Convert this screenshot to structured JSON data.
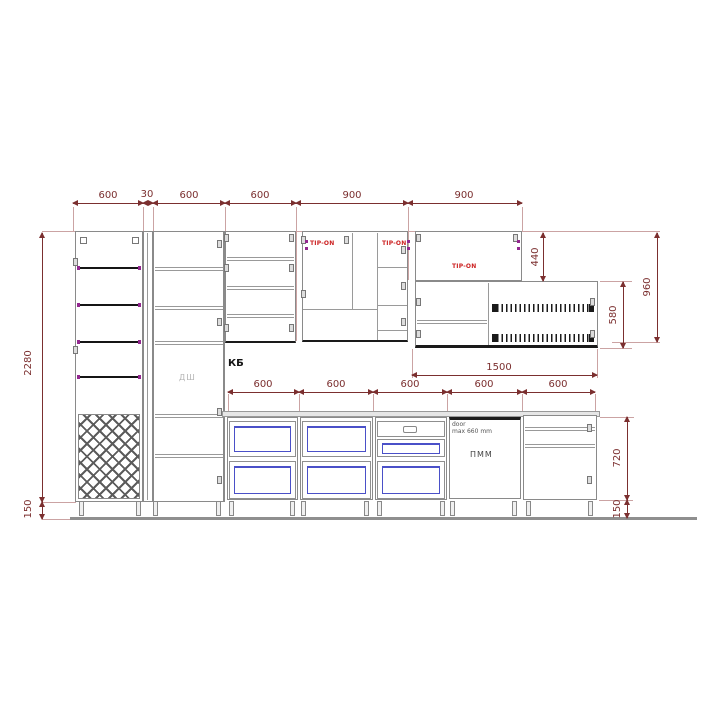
{
  "labels": {
    "kb": "КБ",
    "dsh": "ДШ",
    "pmm": "ПММ",
    "tip_on": "TIP-ON",
    "door_note_l1": "door",
    "door_note_l2": "max 660 mm"
  },
  "dimensions": {
    "top": [
      "600",
      "30",
      "600",
      "600",
      "900",
      "900"
    ],
    "counter": [
      "600",
      "600",
      "600",
      "600",
      "600"
    ],
    "counter_total": "1500",
    "left_height": "2280",
    "left_plinth": "150",
    "right_upper_door": "440",
    "right_upper_total": "960",
    "right_upper_cab": "580",
    "right_base": "720",
    "right_plinth": "150"
  },
  "colors": {
    "dimension": "#7b2f2f",
    "tip_on": "#cc2020",
    "drawer_blue": "#4a50c8",
    "fitting_purple": "#92278f",
    "carcass_gray": "#8a8a8a",
    "shelf_dark": "#1a1a1a"
  }
}
